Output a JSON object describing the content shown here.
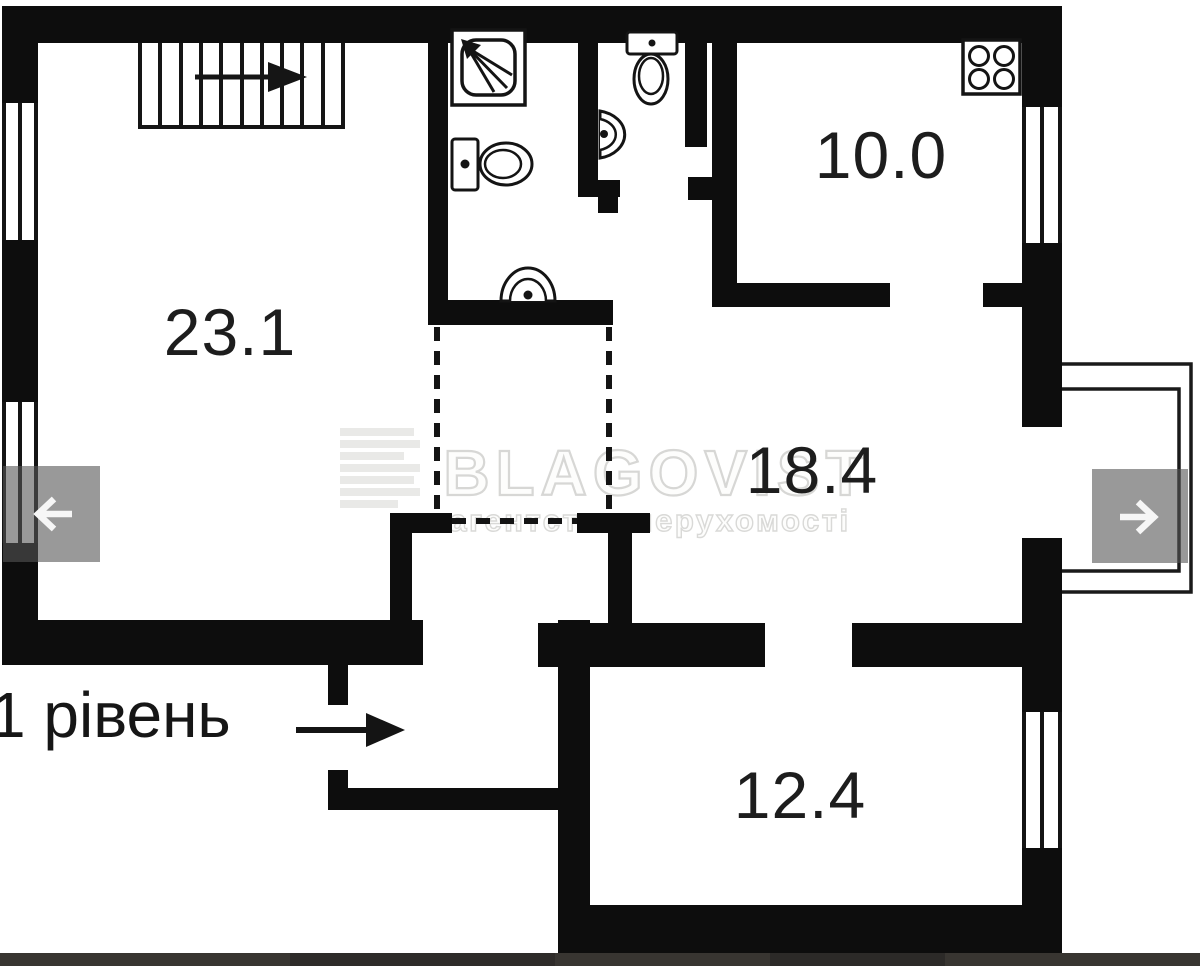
{
  "plan": {
    "level_label": "1 рівень",
    "rooms": [
      {
        "area": "23.1"
      },
      {
        "area": "10.0"
      },
      {
        "area": "18.4"
      },
      {
        "area": "12.4"
      }
    ]
  },
  "watermark": {
    "brand": "BLAGOVIST",
    "subtitle": "агентство нерухомості"
  },
  "icons": {
    "nav_prev": "arrow-left",
    "nav_next": "arrow-right",
    "stairs_direction": "arrow-right",
    "entrance_direction": "arrow-right",
    "fixtures": [
      "stairs",
      "shower",
      "toilet",
      "sink",
      "toilet",
      "sink",
      "stove"
    ]
  },
  "colors": {
    "wall": "#0d0d0d",
    "watermark_gray": "#d9d9d7",
    "nav_overlay": "rgba(85,85,85,0.6)",
    "bottom_bar": "#383531"
  }
}
